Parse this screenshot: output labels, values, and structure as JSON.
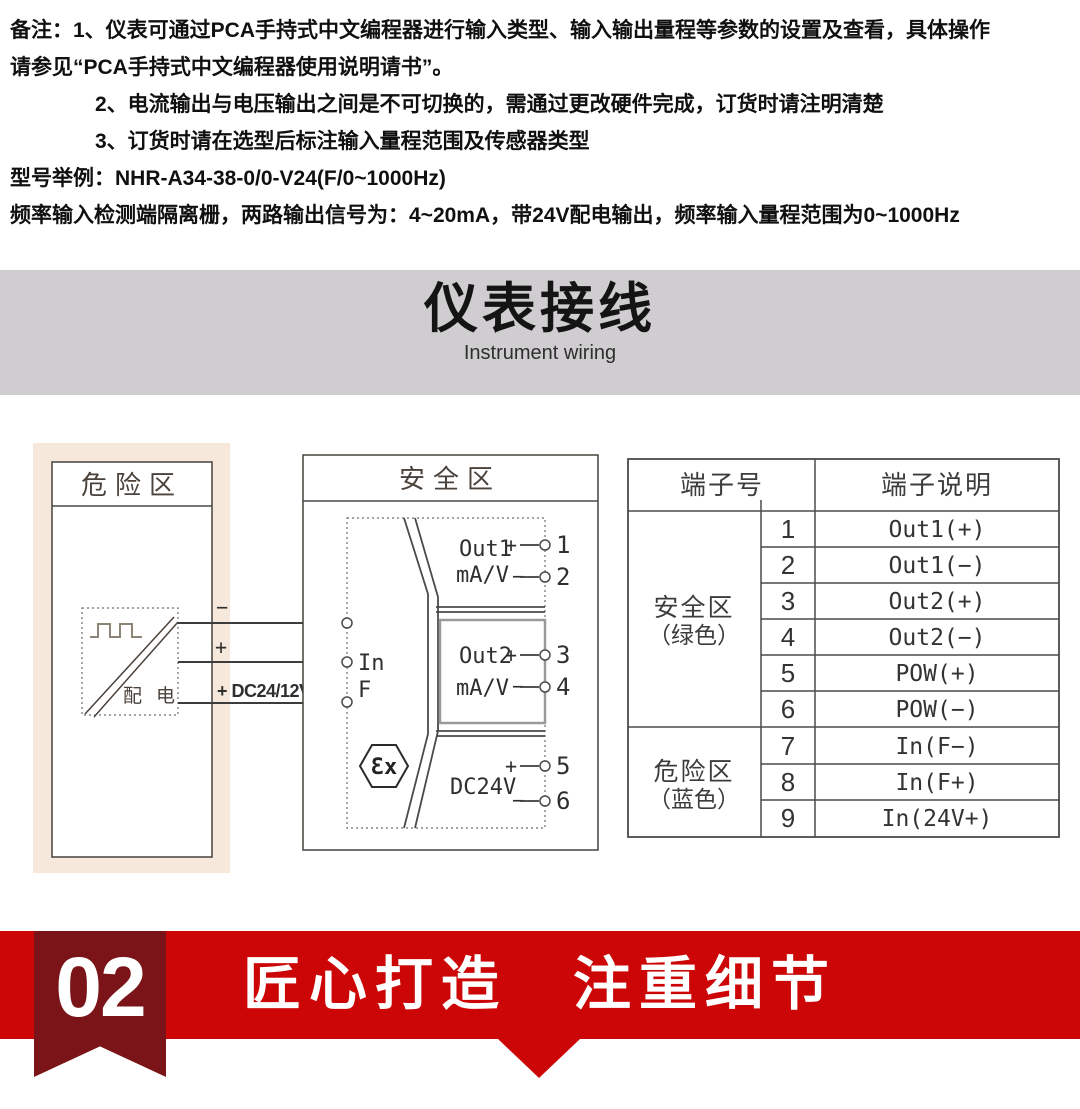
{
  "notes": [
    "备注：1、仪表可通过PCA手持式中文编程器进行输入类型、输入输出量程等参数的设置及查看，具体操作",
    "请参见“PCA手持式中文编程器使用说明请书”。",
    "2、电流输出与电压输出之间是不可切换的，需通过更改硬件完成，订货时请注明清楚",
    "3、订货时请在选型后标注输入量程范围及传感器类型",
    "型号举例：NHR-A34-38-0/0-V24(F/0~1000Hz)",
    "频率输入检测端隔离栅，两路输出信号为：4~20mA，带24V配电输出，频率输入量程范围为0~1000Hz"
  ],
  "banner": {
    "title": "仪表接线",
    "subtitle": "Instrument wiring"
  },
  "diagram": {
    "hazard": {
      "title": "危险区",
      "device": "配 电",
      "wires": [
        {
          "label": "−",
          "terminal": "7"
        },
        {
          "label": "+",
          "terminal": "8"
        },
        {
          "label": "+ DC24/12V",
          "terminal": "9"
        }
      ]
    },
    "safe": {
      "title": "安全区",
      "input_line1": "In",
      "input_line2": "F",
      "ex_mark": "Ɛx",
      "channels": [
        {
          "name": "Out1",
          "unit": "mA/V",
          "plus": "+",
          "minus": "−",
          "plus_terminal": "1",
          "minus_terminal": "2"
        },
        {
          "name": "Out2",
          "unit": "mA/V",
          "plus": "+",
          "minus": "−",
          "plus_terminal": "3",
          "minus_terminal": "4"
        },
        {
          "name": "DC24V",
          "plus": "+",
          "minus": "−",
          "plus_terminal": "5",
          "minus_terminal": "6"
        }
      ]
    },
    "table": {
      "col1_header": "端子号",
      "col2_header": "端子说明",
      "groups": [
        {
          "name": "安全区",
          "color_note": "（绿色）"
        },
        {
          "name": "危险区",
          "color_note": "（蓝色）"
        }
      ],
      "rows": [
        {
          "no": "1",
          "desc": "Out1(+)"
        },
        {
          "no": "2",
          "desc": "Out1(−)"
        },
        {
          "no": "3",
          "desc": "Out2(+)"
        },
        {
          "no": "4",
          "desc": "Out2(−)"
        },
        {
          "no": "5",
          "desc": "POW(+)"
        },
        {
          "no": "6",
          "desc": "POW(−)"
        },
        {
          "no": "7",
          "desc": "In(F−)"
        },
        {
          "no": "8",
          "desc": "In(F+)"
        },
        {
          "no": "9",
          "desc": "In(24V+)"
        }
      ]
    }
  },
  "footer": {
    "badge": "02",
    "slogan": "匠心打造　注重细节"
  },
  "colors": {
    "accent_red": "#cc0606",
    "ribbon_dark_red": "#7a1418",
    "banner_gray": "#cfcdcf",
    "hazard_beige": "#f6e9dc"
  }
}
